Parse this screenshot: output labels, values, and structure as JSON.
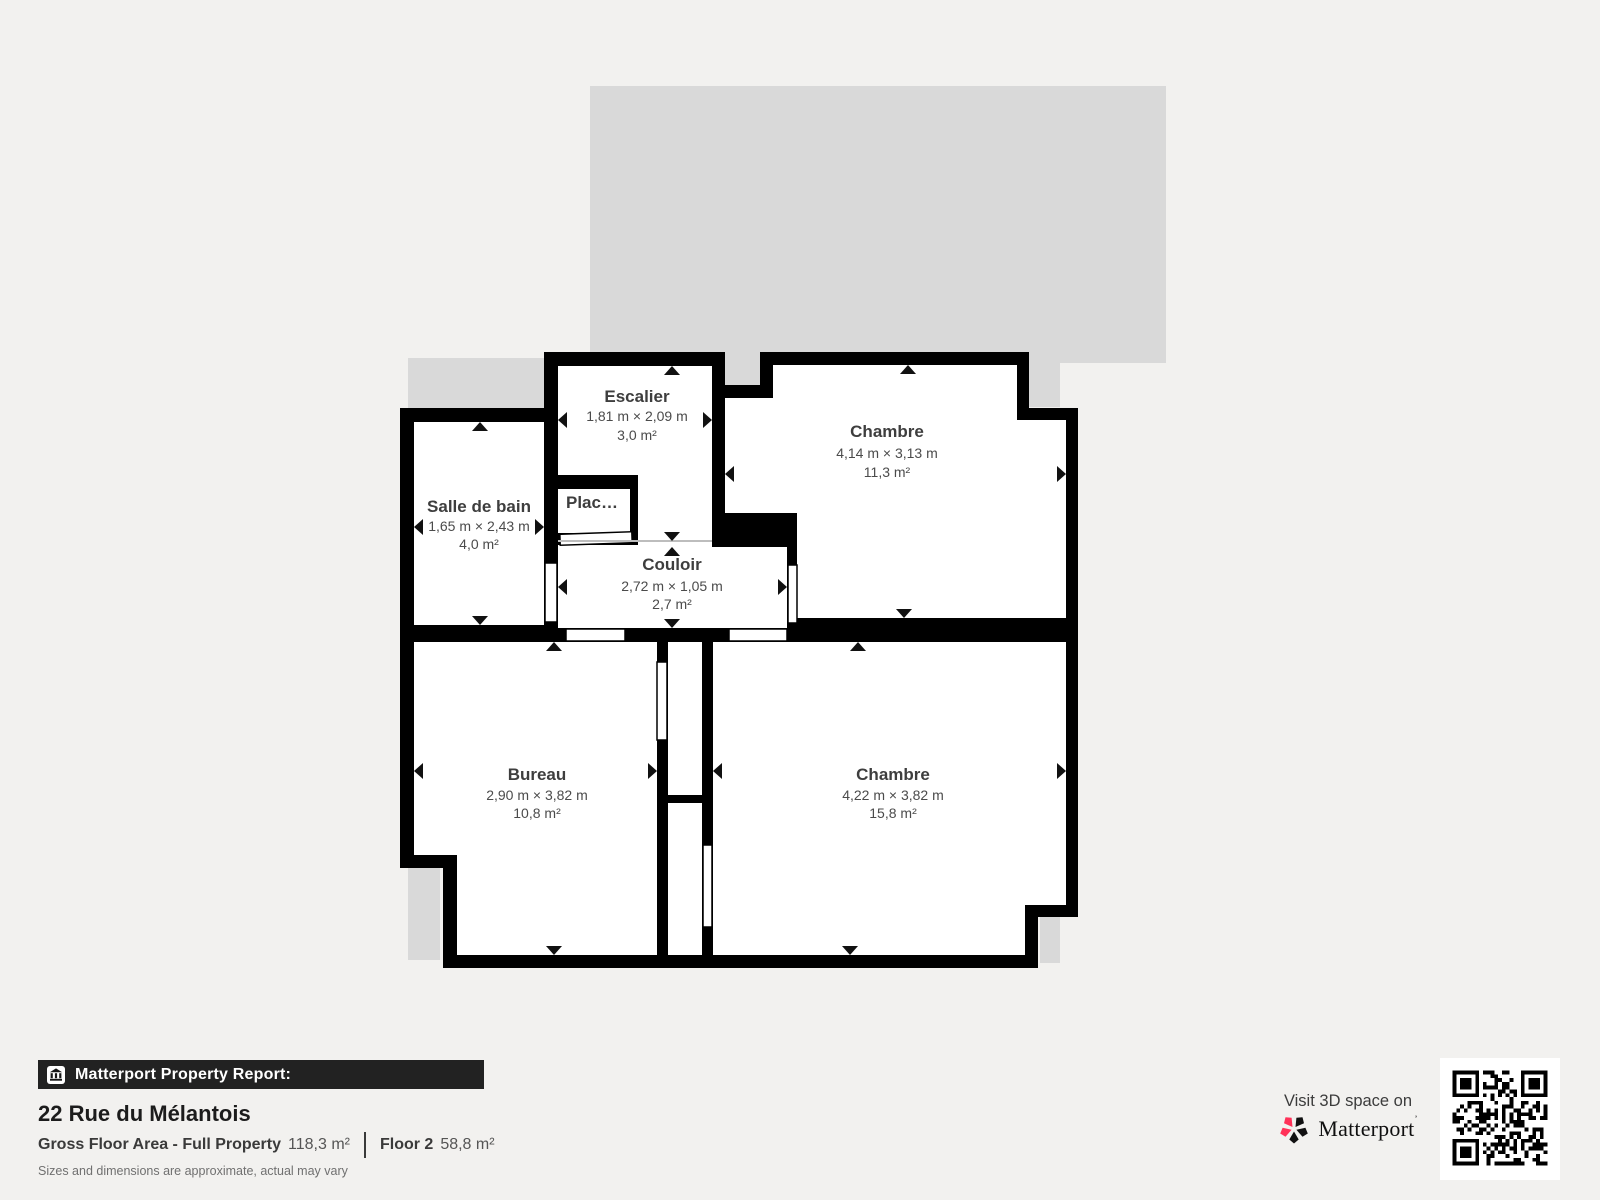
{
  "colors": {
    "background": "#f2f1ef",
    "underlay_gray": "#d9d9d9",
    "wall": "#000000",
    "label_dark": "#3e3e3e",
    "brand_red": "#ff3158",
    "report_bar_bg": "#222222"
  },
  "plan": {
    "rooms": [
      {
        "id": "escalier",
        "name": "Escalier",
        "dims": "1,81 m × 2,09 m",
        "area": "3,0 m²"
      },
      {
        "id": "chambre-top",
        "name": "Chambre",
        "dims": "4,14 m × 3,13 m",
        "area": "11,3 m²"
      },
      {
        "id": "salle-de-bain",
        "name": "Salle de bain",
        "dims": "1,65 m × 2,43 m",
        "area": "4,0 m²"
      },
      {
        "id": "placard",
        "name": "Plac…"
      },
      {
        "id": "couloir",
        "name": "Couloir",
        "dims": "2,72 m × 1,05 m",
        "area": "2,7 m²"
      },
      {
        "id": "bureau",
        "name": "Bureau",
        "dims": "2,90 m × 3,82 m",
        "area": "10,8 m²"
      },
      {
        "id": "chambre-bottom",
        "name": "Chambre",
        "dims": "4,22 m × 3,82 m",
        "area": "15,8 m²"
      }
    ]
  },
  "footer": {
    "report_label": "Matterport Property Report:",
    "address": "22 Rue du Mélantois",
    "gfa_label": "Gross Floor Area - Full Property",
    "gfa_value": "118,3 m²",
    "floor_label": "Floor 2",
    "floor_value": "58,8 m²",
    "disclaimer": "Sizes and dimensions are approximate, actual may vary"
  },
  "cta": {
    "visit_label": "Visit 3D space on",
    "brand": "Matterport",
    "brand_mark": "’"
  }
}
